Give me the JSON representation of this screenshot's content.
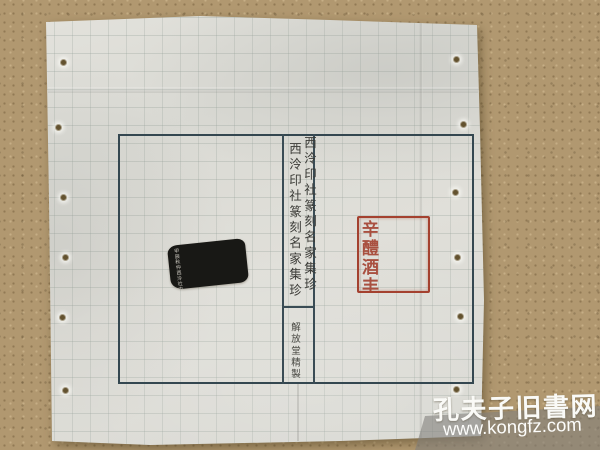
{
  "cover": {
    "title_outer": "西泠印社篆刻名家集珍",
    "title_inner": "西泠印社篆刻名家集珍",
    "colophon": "解放堂精製",
    "frame_color": "#344750",
    "red_seal": {
      "legible": false,
      "style": "square red-line (zhuwen) seal-script impression",
      "color": "#a4412f",
      "approx_glyphs": "辛醴酒丰申號琳美眞鏽"
    },
    "black_rubbing": {
      "legible": false,
      "style": "ink rubbing of seal side-inscription, tiny white characters on black, tilted",
      "color": "#181815",
      "approx_glyphs": "甲辰秋仲西泠社中人作邊款記之歲在丙午春日鈍叟刻於孤山之麓並記石上永寶用之"
    }
  },
  "watermark": {
    "site_name": "孔夫子旧書网",
    "site_url": "www.kongfz.com",
    "band_color": "rgba(128,126,122,0.58)"
  },
  "colors": {
    "table_surface": "#b19870",
    "paper": "#dcdbd5",
    "grid_line": "#929e96",
    "seal_red": "#a4412f",
    "frame_teal": "#344750"
  }
}
